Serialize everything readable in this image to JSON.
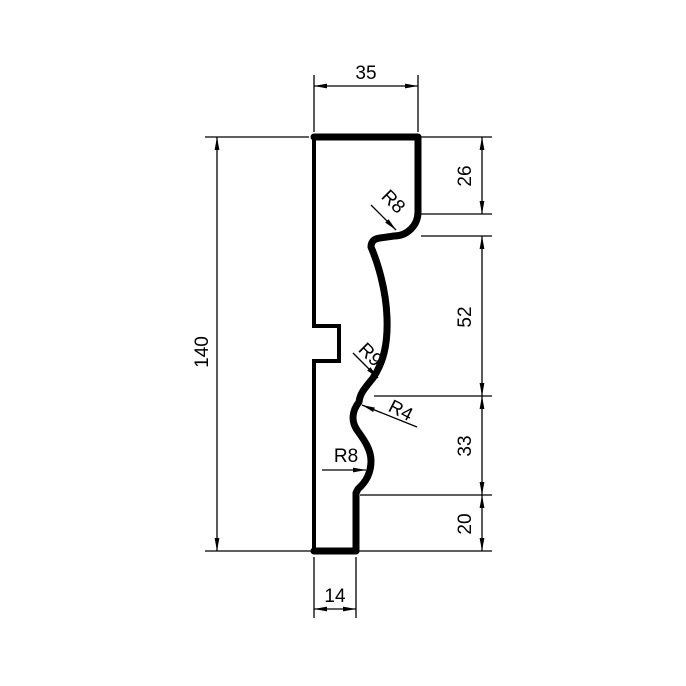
{
  "drawing": {
    "type": "technical-profile-drawing",
    "background_color": "#ffffff",
    "line_color": "#000000",
    "labels": {
      "width_top": "35",
      "height_total": "140",
      "seg_top": "26",
      "seg_upper_mid": "52",
      "seg_lower_mid": "33",
      "seg_bottom": "20",
      "width_bottom": "14",
      "radius_top": "R8",
      "radius_ogee_upper": "R9",
      "radius_ogee_lower": "R4",
      "radius_bottom": "R8"
    }
  }
}
